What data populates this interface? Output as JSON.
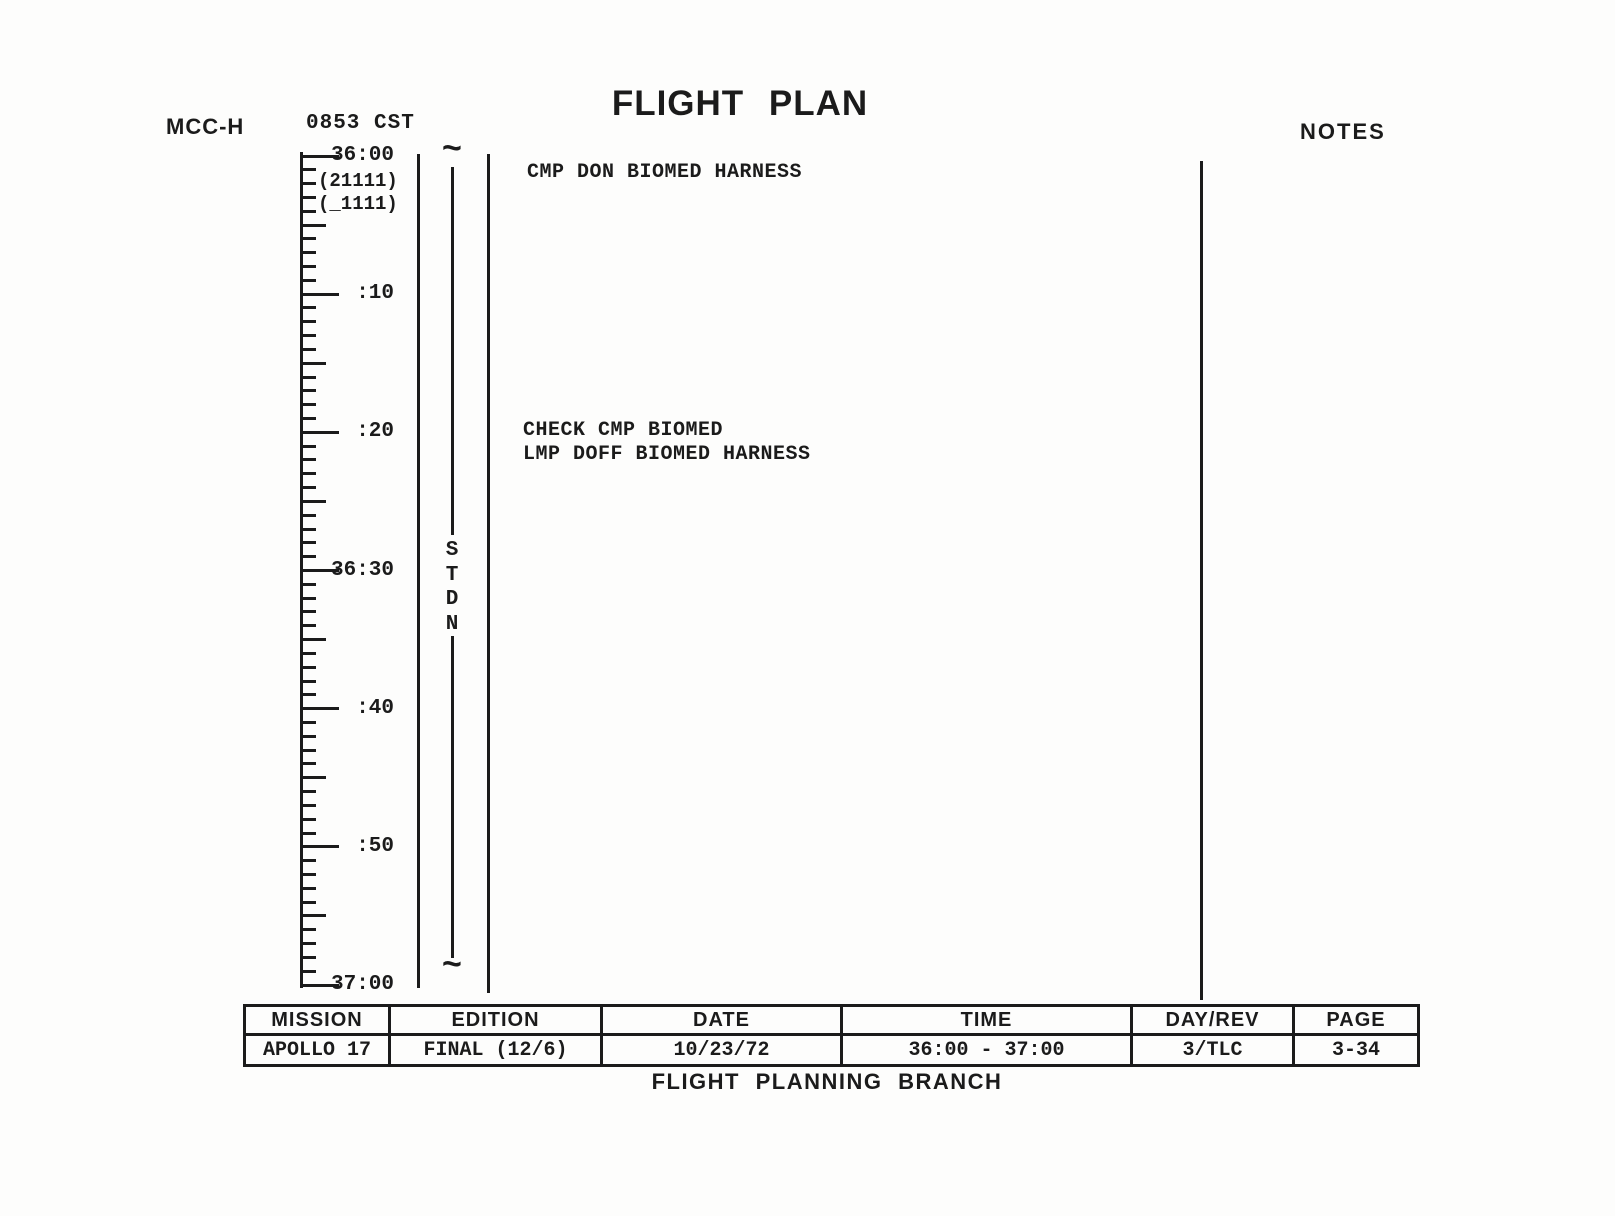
{
  "header": {
    "station": "MCC-H",
    "report_time": "0853 CST",
    "title": "FLIGHT PLAN",
    "notes_label": "NOTES"
  },
  "timeline": {
    "start": "36:00",
    "end": "37:00",
    "tick_labels": [
      "36:00",
      ":10",
      ":20",
      "36:30",
      ":40",
      ":50",
      "37:00"
    ],
    "status_line1": "(21111)",
    "status_line2": "(_1111)",
    "station_coverage": "STDN"
  },
  "activities": [
    {
      "time": "36:00",
      "text": "CMP DON BIOMED HARNESS"
    },
    {
      "time": "36:19",
      "text": "CHECK CMP BIOMED"
    },
    {
      "time": "36:21",
      "text": "LMP DOFF BIOMED HARNESS"
    }
  ],
  "info_table": {
    "headers": [
      "MISSION",
      "EDITION",
      "DATE",
      "TIME",
      "DAY/REV",
      "PAGE"
    ],
    "values": [
      "APOLLO 17",
      "FINAL (12/6)",
      "10/23/72",
      "36:00 - 37:00",
      "3/TLC",
      "3-34"
    ],
    "column_widths": [
      145,
      212,
      240,
      290,
      162,
      125
    ]
  },
  "footer": {
    "branch": "FLIGHT PLANNING BRANCH"
  },
  "colors": {
    "ink": "#1b1b1b",
    "paper": "#fdfdfc"
  }
}
